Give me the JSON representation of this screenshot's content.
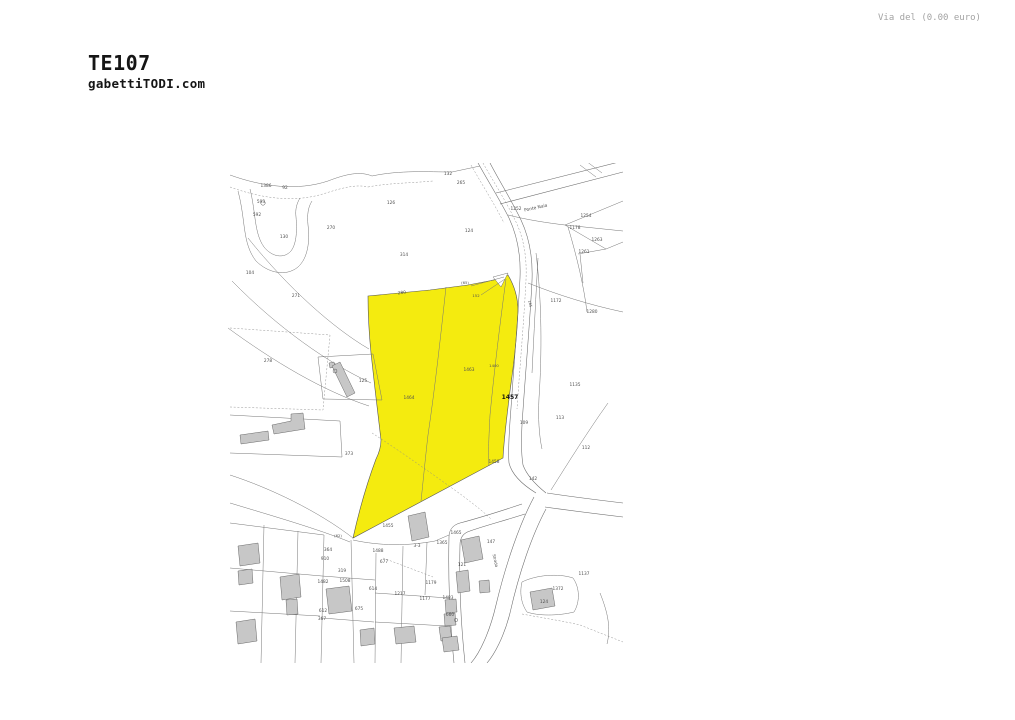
{
  "page": {
    "background": "#ffffff"
  },
  "header": {
    "title": "TE107",
    "subtitle": "gabettiTODI.com",
    "text_color": "#151515"
  },
  "top_note": {
    "text": "Via del (0.00 euro)",
    "color": "#a3a3a3"
  },
  "map": {
    "type": "cadastral-plan",
    "colors": {
      "highlight": "#f4eb0f",
      "boundary_line": "#767676",
      "building_fill": "#c7c7c7",
      "label": "#4f4f4f",
      "bold_label": "#111111"
    },
    "highlighted_parcel": {
      "main_label": "1457",
      "sub_parcels": [
        "1464",
        "1463",
        "1400"
      ]
    },
    "road_names": [
      {
        "t": "Ponte Naia",
        "x": 308,
        "y": 46,
        "r": -13,
        "s": 4.4
      },
      {
        "t": "Strada",
        "x": 266,
        "y": 398,
        "r": 78,
        "s": 4
      }
    ],
    "labels": [
      {
        "t": "1386",
        "x": 38,
        "y": 24
      },
      {
        "t": "92",
        "x": 57,
        "y": 26
      },
      {
        "t": "593",
        "x": 33,
        "y": 40
      },
      {
        "t": "592",
        "x": 29,
        "y": 53
      },
      {
        "t": "130",
        "x": 56,
        "y": 75
      },
      {
        "t": "270",
        "x": 103,
        "y": 66
      },
      {
        "t": "126",
        "x": 163,
        "y": 41
      },
      {
        "t": "104",
        "x": 22,
        "y": 111
      },
      {
        "t": "271",
        "x": 68,
        "y": 134
      },
      {
        "t": "314",
        "x": 176,
        "y": 93
      },
      {
        "t": "132",
        "x": 220,
        "y": 12
      },
      {
        "t": "265",
        "x": 233,
        "y": 21
      },
      {
        "t": "1252",
        "x": 288,
        "y": 47
      },
      {
        "t": "124",
        "x": 241,
        "y": 69
      },
      {
        "t": "1254",
        "x": 358,
        "y": 54
      },
      {
        "t": "1178",
        "x": 347,
        "y": 66
      },
      {
        "t": "1263",
        "x": 369,
        "y": 78
      },
      {
        "t": "1261",
        "x": 356,
        "y": 90
      },
      {
        "t": "1172",
        "x": 328,
        "y": 139
      },
      {
        "t": "1280",
        "x": 364,
        "y": 150
      },
      {
        "t": "280",
        "x": 174,
        "y": 131,
        "r": -6
      },
      {
        "t": "(65)",
        "x": 237,
        "y": 121,
        "s": 3.8
      },
      {
        "t": "152",
        "x": 248,
        "y": 134,
        "s": 3.8
      },
      {
        "t": "1464",
        "x": 181,
        "y": 236
      },
      {
        "t": "1463",
        "x": 241,
        "y": 208
      },
      {
        "t": "1400",
        "x": 266,
        "y": 204,
        "s": 3.8
      },
      {
        "t": "1457",
        "x": 282,
        "y": 236,
        "b": true,
        "s": 6
      },
      {
        "t": "185",
        "x": 301,
        "y": 141,
        "r": 75,
        "s": 3.6
      },
      {
        "t": "1135",
        "x": 347,
        "y": 223
      },
      {
        "t": "113",
        "x": 332,
        "y": 256
      },
      {
        "t": "109",
        "x": 296,
        "y": 261
      },
      {
        "t": "1458",
        "x": 266,
        "y": 300
      },
      {
        "t": "142",
        "x": 305,
        "y": 317
      },
      {
        "t": "112",
        "x": 358,
        "y": 286
      },
      {
        "t": "278",
        "x": 40,
        "y": 199
      },
      {
        "t": "125",
        "x": 135,
        "y": 219
      },
      {
        "t": "373",
        "x": 121,
        "y": 292
      },
      {
        "t": "1455",
        "x": 160,
        "y": 364
      },
      {
        "t": "1465",
        "x": 228,
        "y": 371
      },
      {
        "t": "(62)",
        "x": 110,
        "y": 374,
        "s": 3.8
      },
      {
        "t": "364",
        "x": 100,
        "y": 388
      },
      {
        "t": "1488",
        "x": 150,
        "y": 389
      },
      {
        "t": "3-3",
        "x": 189,
        "y": 384
      },
      {
        "t": "1365",
        "x": 214,
        "y": 381
      },
      {
        "t": "910",
        "x": 97,
        "y": 397
      },
      {
        "t": "677",
        "x": 156,
        "y": 400
      },
      {
        "t": "121",
        "x": 234,
        "y": 403
      },
      {
        "t": "319",
        "x": 114,
        "y": 409
      },
      {
        "t": "1508",
        "x": 117,
        "y": 419
      },
      {
        "t": "614",
        "x": 145,
        "y": 427
      },
      {
        "t": "1217",
        "x": 172,
        "y": 432
      },
      {
        "t": "1179",
        "x": 203,
        "y": 421
      },
      {
        "t": "1177",
        "x": 197,
        "y": 437
      },
      {
        "t": "675",
        "x": 131,
        "y": 447
      },
      {
        "t": "612",
        "x": 95,
        "y": 449
      },
      {
        "t": "367",
        "x": 94,
        "y": 457
      },
      {
        "t": "660",
        "x": 222,
        "y": 453
      },
      {
        "t": "1482",
        "x": 95,
        "y": 420
      },
      {
        "t": "1483",
        "x": 220,
        "y": 436
      },
      {
        "t": "147",
        "x": 263,
        "y": 380
      },
      {
        "t": "1372",
        "x": 330,
        "y": 427
      },
      {
        "t": "124",
        "x": 316,
        "y": 440
      },
      {
        "t": "1137",
        "x": 356,
        "y": 412
      }
    ]
  }
}
